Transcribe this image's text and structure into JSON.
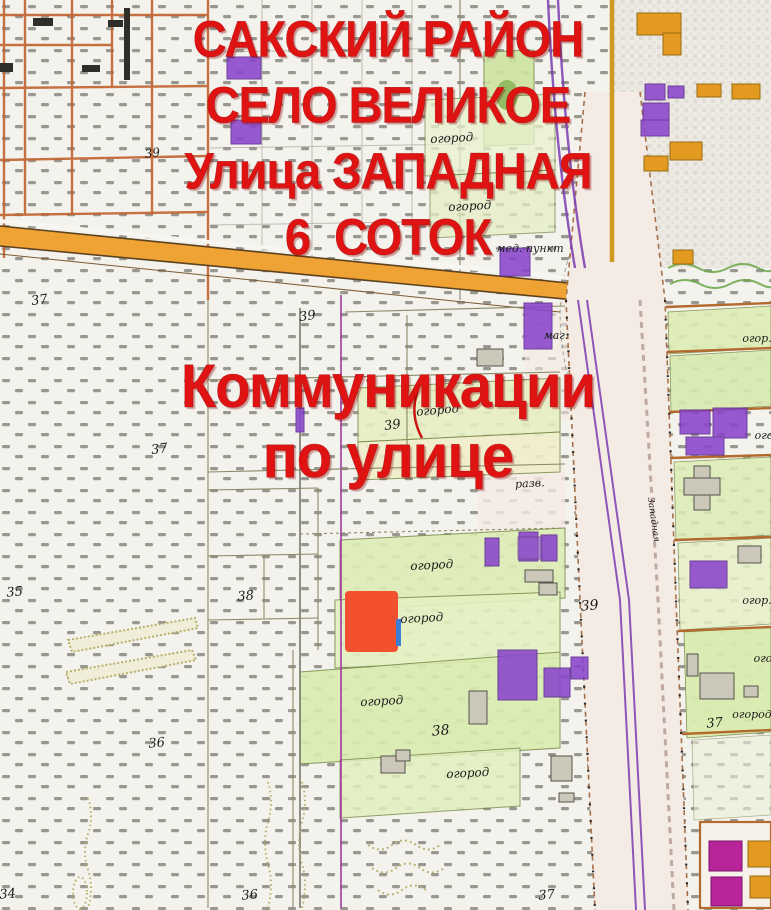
{
  "title_overlay": {
    "color": "#e01313",
    "top_lines": [
      "САКСКИЙ РАЙОН",
      "СЕЛО ВЕЛИКОЕ",
      "Улица ЗАПАДНАЯ",
      "6  СОТОК"
    ],
    "middle_lines": [
      "Коммуникации",
      "по улице"
    ]
  },
  "plot_marker": {
    "color": "#f2502f"
  },
  "map": {
    "labels": [
      {
        "text": "огород",
        "x": 452,
        "y": 142,
        "size": 12,
        "rotate": -3
      },
      {
        "text": "огород",
        "x": 470,
        "y": 210,
        "size": 12,
        "rotate": -3
      },
      {
        "text": "мед. пункт",
        "x": 530,
        "y": 252,
        "size": 11
      },
      {
        "text": "маг.",
        "x": 556,
        "y": 339,
        "size": 11
      },
      {
        "text": "39",
        "x": 153,
        "y": 157,
        "size": 12,
        "rotate": -8
      },
      {
        "text": "37",
        "x": 40,
        "y": 304,
        "size": 13,
        "rotate": -8
      },
      {
        "text": "39",
        "x": 308,
        "y": 320,
        "size": 13,
        "rotate": -8
      },
      {
        "text": "37",
        "x": 160,
        "y": 453,
        "size": 13,
        "rotate": -8
      },
      {
        "text": "39",
        "x": 393,
        "y": 429,
        "size": 13,
        "rotate": -8
      },
      {
        "text": "огород",
        "x": 438,
        "y": 414,
        "size": 12,
        "rotate": -5
      },
      {
        "text": "разв.",
        "x": 530,
        "y": 487,
        "size": 11,
        "rotate": -3
      },
      {
        "text": "огород",
        "x": 432,
        "y": 569,
        "size": 12,
        "rotate": -3
      },
      {
        "text": "огород",
        "x": 422,
        "y": 622,
        "size": 12,
        "rotate": -3
      },
      {
        "text": "39",
        "x": 590,
        "y": 610,
        "size": 14,
        "rotate": -5
      },
      {
        "text": "огород",
        "x": 382,
        "y": 705,
        "size": 12,
        "rotate": -3
      },
      {
        "text": "38",
        "x": 441,
        "y": 735,
        "size": 14,
        "rotate": -5
      },
      {
        "text": "огород",
        "x": 468,
        "y": 777,
        "size": 12,
        "rotate": -3
      },
      {
        "text": "38",
        "x": 246,
        "y": 600,
        "size": 13,
        "rotate": -5
      },
      {
        "text": "35",
        "x": 15,
        "y": 596,
        "size": 13,
        "rotate": -5
      },
      {
        "text": "36",
        "x": 157,
        "y": 747,
        "size": 13,
        "rotate": -5
      },
      {
        "text": "34",
        "x": 8,
        "y": 898,
        "size": 13,
        "rotate": -5
      },
      {
        "text": "36",
        "x": 250,
        "y": 899,
        "size": 13,
        "rotate": -5
      },
      {
        "text": "37",
        "x": 547,
        "y": 899,
        "size": 13,
        "rotate": -5
      },
      {
        "text": "37",
        "x": 715,
        "y": 727,
        "size": 13,
        "rotate": -5
      },
      {
        "text": "огор.",
        "x": 757,
        "y": 342,
        "size": 11
      },
      {
        "text": "ого",
        "x": 764,
        "y": 439,
        "size": 11
      },
      {
        "text": "огор.",
        "x": 757,
        "y": 604,
        "size": 11
      },
      {
        "text": "ого",
        "x": 763,
        "y": 662,
        "size": 11
      },
      {
        "text": "огород",
        "x": 752,
        "y": 718,
        "size": 11
      },
      {
        "text": "Западная",
        "x": 651,
        "y": 520,
        "size": 9,
        "rotate": 82
      }
    ],
    "colors": {
      "overlay_text": "#e01313",
      "plot_marker": "#f2502f",
      "road_fill": "#f0a335",
      "street_fill": "#f5ebe5",
      "power_line": "#7b3cb0",
      "parcel_fence": "#b26a2e",
      "garden_green": "#dcecb2",
      "building_purple": "#8a45cc",
      "building_orange": "#e29a20",
      "building_grey": "#cbc8ba",
      "building_magenta": "#b8249a"
    }
  }
}
